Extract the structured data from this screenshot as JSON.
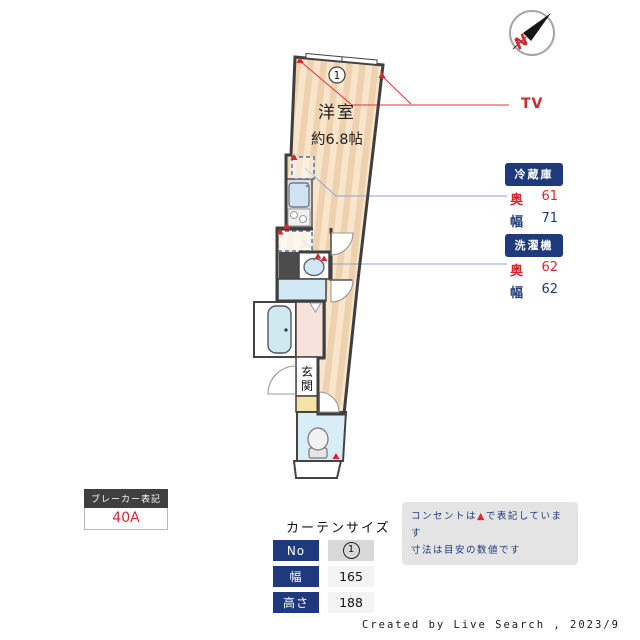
{
  "compass": {
    "letter": "N"
  },
  "plan": {
    "room_label": "洋室",
    "room_size": "約6.8帖",
    "room_number": "1",
    "entrance_label": "玄関",
    "tv_label": "TV",
    "fridge": {
      "title": "冷蔵庫",
      "depth_label": "奥",
      "depth_value": "61",
      "width_label": "幅",
      "width_value": "71"
    },
    "washer": {
      "title": "洗濯機",
      "depth_label": "奥",
      "depth_value": "62",
      "width_label": "幅",
      "width_value": "62"
    }
  },
  "breaker": {
    "title": "ブレーカー表記",
    "value": "40A"
  },
  "curtain": {
    "title": "カーテンサイズ",
    "rows": [
      {
        "label": "No",
        "value": "1"
      },
      {
        "label": "幅",
        "value": "165"
      },
      {
        "label": "高さ",
        "value": "188"
      }
    ]
  },
  "notes": {
    "line1_pre": "コンセントは",
    "line1_mark": "▲",
    "line1_post": "で表記しています",
    "line2": "寸法は目安の数値です"
  },
  "footer": "Created by Live Search , 2023/9",
  "icons": [
    "compass-icon",
    "outlet-triangle-icon",
    "toilet-icon",
    "bathtub-icon",
    "sink-icon",
    "stove-icon",
    "washbasin-icon",
    "door-swing-icon",
    "window-icon"
  ],
  "colors": {
    "accent_red": "#d8262d",
    "navy": "#1e3a7c",
    "wall": "#3f3f3f",
    "floor_beige": "#f9e4cc",
    "floor_stripe": "#eed2af",
    "water_blue": "#d2e8f4",
    "bath_blue": "#cfe9f0",
    "room_pink": "#f8e2dc",
    "entry_yellow": "#f6e2a8",
    "leader_blue": "#8ea6cf",
    "note_bg": "#e4e4e4"
  }
}
